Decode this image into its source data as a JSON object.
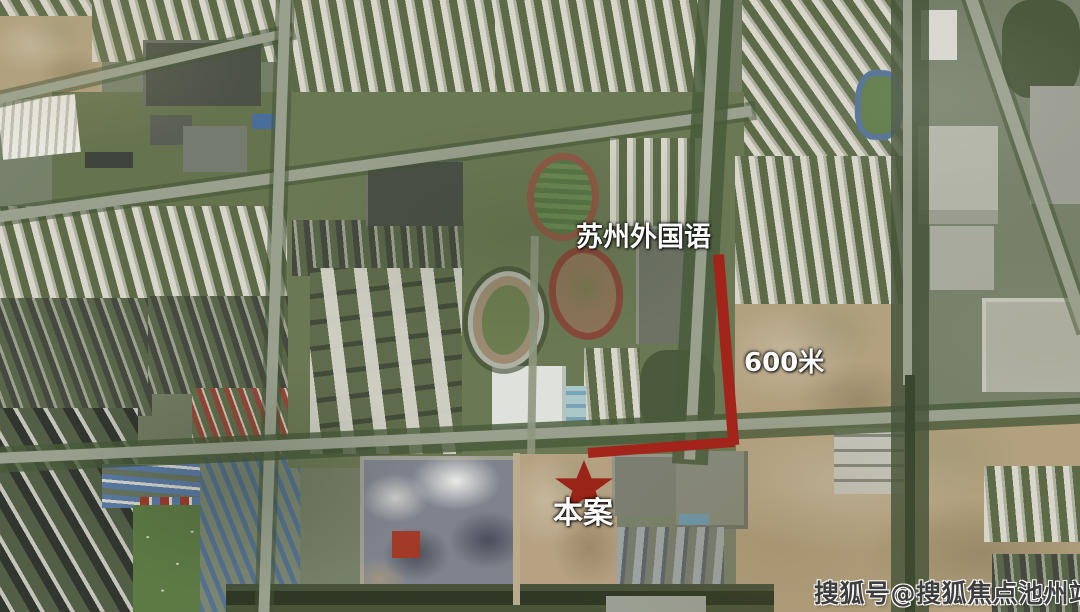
{
  "map": {
    "kind": "satellite-map",
    "annotations": {
      "school_label": "苏州外国语",
      "distance_label": "600米",
      "site_label": "本案",
      "marker_shape": "star",
      "line_color": "#a2241a",
      "star_color": "#9a2418",
      "label_color": "#ffffff"
    },
    "watermark": {
      "text": "搜狐号@搜狐焦点池州站",
      "color": "#3d3d3d"
    }
  }
}
